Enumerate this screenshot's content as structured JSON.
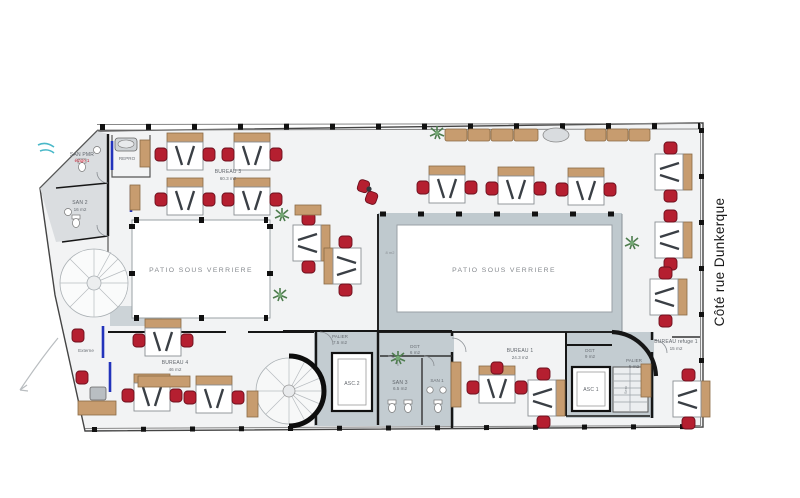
{
  "street_label": "Côté rue Dunkerque",
  "patios": {
    "left_label": "PATIO SOUS VERRIERE",
    "right_label": "PATIO SOUS VERRIERE",
    "edge_area": "8 m2"
  },
  "rooms": {
    "bureau3": {
      "name": "BUREAU 3",
      "area": "60.3 m2"
    },
    "bureau4": {
      "name": "BUREAU 4",
      "area": "46 m2"
    },
    "bureau1": {
      "name": "BUREAU 1",
      "area": "24.3 m2"
    },
    "bureau_refuge1": {
      "name": "BUREAU refuge 1",
      "area": "15 m2"
    },
    "san_pmr": {
      "name": "SAN PMR",
      "note": "étage 1"
    },
    "san2": {
      "name": "SAN 2",
      "area": "16 m2"
    },
    "san3": {
      "name": "SAN 3",
      "area": "6.5 m2"
    },
    "san1": {
      "name": "SAN 1"
    },
    "repro": {
      "name": "REPRO"
    },
    "externe": {
      "name": "Externe"
    },
    "palier_center": {
      "name": "PALIER",
      "area": "7.5 m2"
    },
    "palier_right": {
      "name": "PALIER",
      "area": "5 m2"
    },
    "dgt_center": {
      "name": "DGT",
      "area": "6 m2"
    },
    "dgt_right": {
      "name": "DGT",
      "area": "9 m2"
    },
    "asc2": {
      "name": "ASC.2"
    },
    "asc1": {
      "name": "ASC 1"
    },
    "serv": {
      "name": "Serv"
    }
  },
  "colors": {
    "zone_gray": "#bfc9ce",
    "floor": "#f2f3f4",
    "chair_red": "#b51f30",
    "wood_tan": "#c79c6f",
    "accent_blue": "#2233bb",
    "plant_green": "#5d8f5d"
  }
}
